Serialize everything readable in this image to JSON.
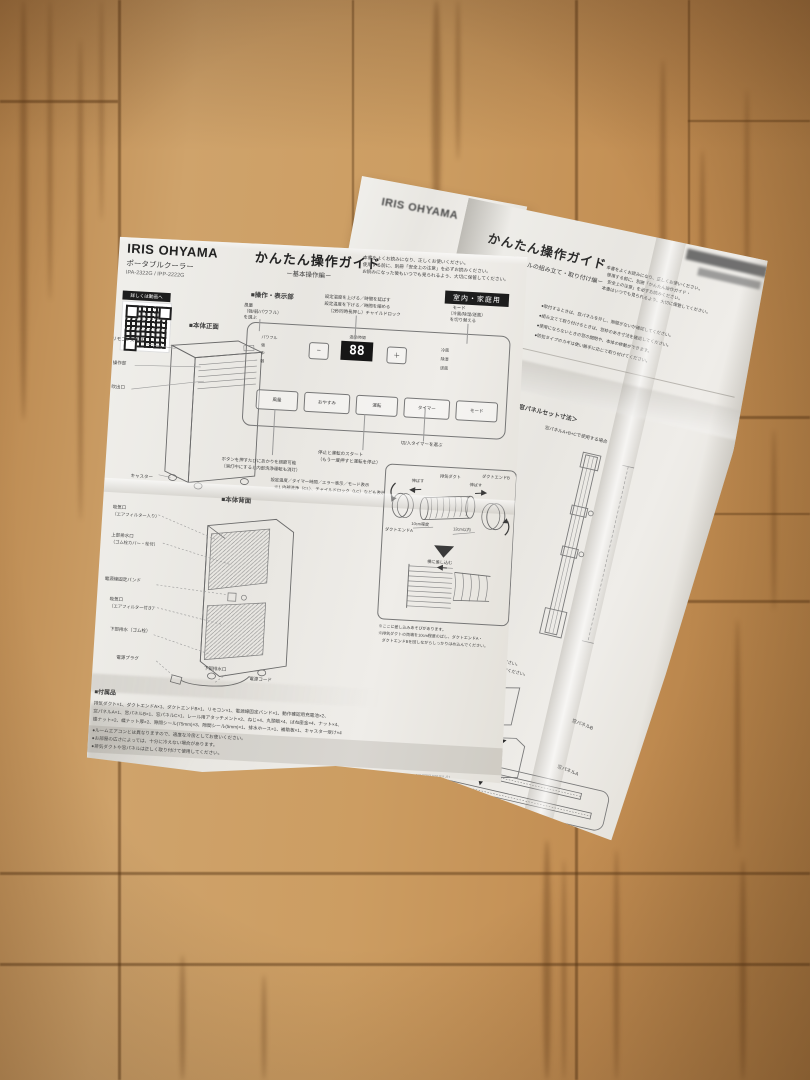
{
  "back_sheet": {
    "brand": "IRIS OHYAMA"
  },
  "left_sheet": {
    "brand": "IRIS OHYAMA",
    "product": "ポータブルクーラー",
    "models": "IPA-2322G / IPP-2222G",
    "title": "かんたん操作ガイド",
    "subtitle": "－基本操作編－",
    "intro": [
      "本書をよくお読みになり、正しくお使いください。",
      "使用する前に、別冊「安全上の注意」を必ずお読みください。",
      "お読みになった後もいつでも見られるよう、大切に保管してください。"
    ],
    "badge": "室内・家庭用",
    "qr_label": "詳しくは動画へ",
    "front_section": {
      "heading": "■本体正面",
      "labels": [
        "リモコン受信部",
        "操作部",
        "吹出口",
        "キャスター"
      ]
    },
    "panel_section": {
      "heading": "■操作・表示部",
      "callout_fan": [
        "風量",
        "（強/弱/パワフル）",
        "を選ぶ"
      ],
      "callout_temp": [
        "設定温度を上げる／時間を延ばす",
        "設定温度を下げる／時間を縮める",
        "（2秒同時長押し）チャイルドロック"
      ],
      "callout_mode": [
        "モード",
        "（冷風/除湿/送風）",
        "を切り替える"
      ],
      "callout_timer": "切/入タイマーを選ぶ",
      "callout_run": [
        "停止と運転のスタート",
        "（もう一度押すと運転を停止）"
      ],
      "callout_light": [
        "ボタンを押すたびにあかりを調節可能",
        "（消灯中にすると内部洗浄運転も消灯）"
      ],
      "callout_display": [
        "設定温度／タイマー時間／エラー表示／モード表示",
        "※1 内部洗浄（CL）、チャイルドロック（LC）なども表示"
      ],
      "fan_levels": [
        "パワフル",
        "強",
        "中",
        "弱"
      ],
      "modes": [
        "冷風",
        "除湿",
        "送風"
      ],
      "display_value": "88",
      "display_caption": "温度/時間",
      "btn_minus": "−",
      "btn_plus": "＋",
      "buttons": [
        "風量",
        "おやすみ",
        "運転",
        "タイマー",
        "モード"
      ]
    },
    "back_section": {
      "heading": "■本体背面",
      "labels": {
        "intake_top": "吸気口",
        "intake_top2": "（エアフィルター入り）",
        "drain_top": "上部排水口",
        "drain_top2": "（ゴム栓カバー・栓付）",
        "cord_band": "電源線固定バンド",
        "intake_low": "吸気口",
        "intake_low2": "（エアフィルター付き）",
        "drain_low": "下部排水（ゴム栓）",
        "plug": "電源プラグ",
        "drain_port": "下部排水口",
        "cord": "電源コード"
      }
    },
    "duct_box": {
      "extend_left": "伸ばす",
      "duct": "排気ダクト",
      "extend_right": "伸ばす",
      "end_b": "ダクトエンドB",
      "end_a": "ダクトエンドA",
      "dim_left": "10cm程度",
      "dim_right": "12cm以内",
      "insert": "横に差し込む",
      "notes": [
        "※ここに差し込みあそびがあります。",
        "※排気ダクトの両端を10cm程度のばし、ダクトエンドA・",
        "　ダクトエンドBを回しながらしっかりはめ込んでください。"
      ]
    },
    "accessories": {
      "heading": "■付属品",
      "lines": [
        "排気ダクト×1、ダクトエンドA×1、ダクトエンドB×1、リモコン×1、電源線固定バンド×1、動作確認用充電池×2、",
        "窓パネルA×1、窓パネルB×1、窓パネルC×1、レール用アタッチメント×2、ねじ×4、丸頭板×4、ばね座金×4、ナット×4、",
        "蝶ナット×2、蝶ナット厚×2、隙間シール(75mm)×3、隙間シール(5mm)×1、排水ホース×1、補助板×1、キャスター受け×4"
      ]
    },
    "notes": [
      "●ルームエアコンとは異なりますので、適度な冷房としてお使いください。",
      "●お部屋の広さによっては、十分に冷えない場合があります。",
      "●排気ダクトや窓パネルは正しく取り付けて使用してください。"
    ],
    "footer_code": "NW7703 B91011-01"
  },
  "right_sheet": {
    "title": "かんたん操作ガイド",
    "subtitle": "－窓パネルの組み立て・取り付け編－",
    "intro": [
      "本書をよくお読みになり、正しくお使いください。",
      "使用する前に、別冊「かんたん操作ガイド・",
      "安全上の注意」を必ずお読みください。",
      "本書はいつでも見られるよう、大切に保管してください。"
    ],
    "bullets": [
      "●取付するときは、窓パネルを外し、隙間がないか確認してください。",
      "●組み立てて取り付けるときは、窓枠のあき寸法を確認してください。",
      "●使用にならないときの窓の開閉や、本体の移動ができます。",
      "●防犯タイプのカギは使い勝手に応じて取り付けてください。"
    ],
    "fragments": [
      "イングができます",
      "ルを取り付け",
      "してください。"
    ],
    "panel_dim": {
      "tab": "1",
      "heading": "＜窓パネルセット寸法＞",
      "sub": "窓パネルA+B+Cで使用する場合",
      "labels": [
        "レール用アタッチメント",
        "窓パネルC",
        "窓パネルB",
        "窓パネルA",
        "レール用アタッチメント"
      ]
    },
    "step": {
      "heading": "窓パネルBを窓パネルAに取り付ける",
      "lines": [
        "●窓パネルAの溝に合うように、蝶ナットと蝶ナット厚を使用してください。",
        "●下側が窓パネルA、上側が窓パネルB。窓パネルAの上から差し込んでください。"
      ],
      "common": "パネル(A,B)・(A,B,C) 使用 共通"
    },
    "assembly": {
      "nut": "蝶ナット等",
      "panel_a_left": "窓パネルA",
      "panel_b": "窓パネルB",
      "panel_a": "窓パネルA",
      "section": "断面図",
      "cs_b": "窓パネルB",
      "cs_a": "窓パネルA"
    }
  }
}
